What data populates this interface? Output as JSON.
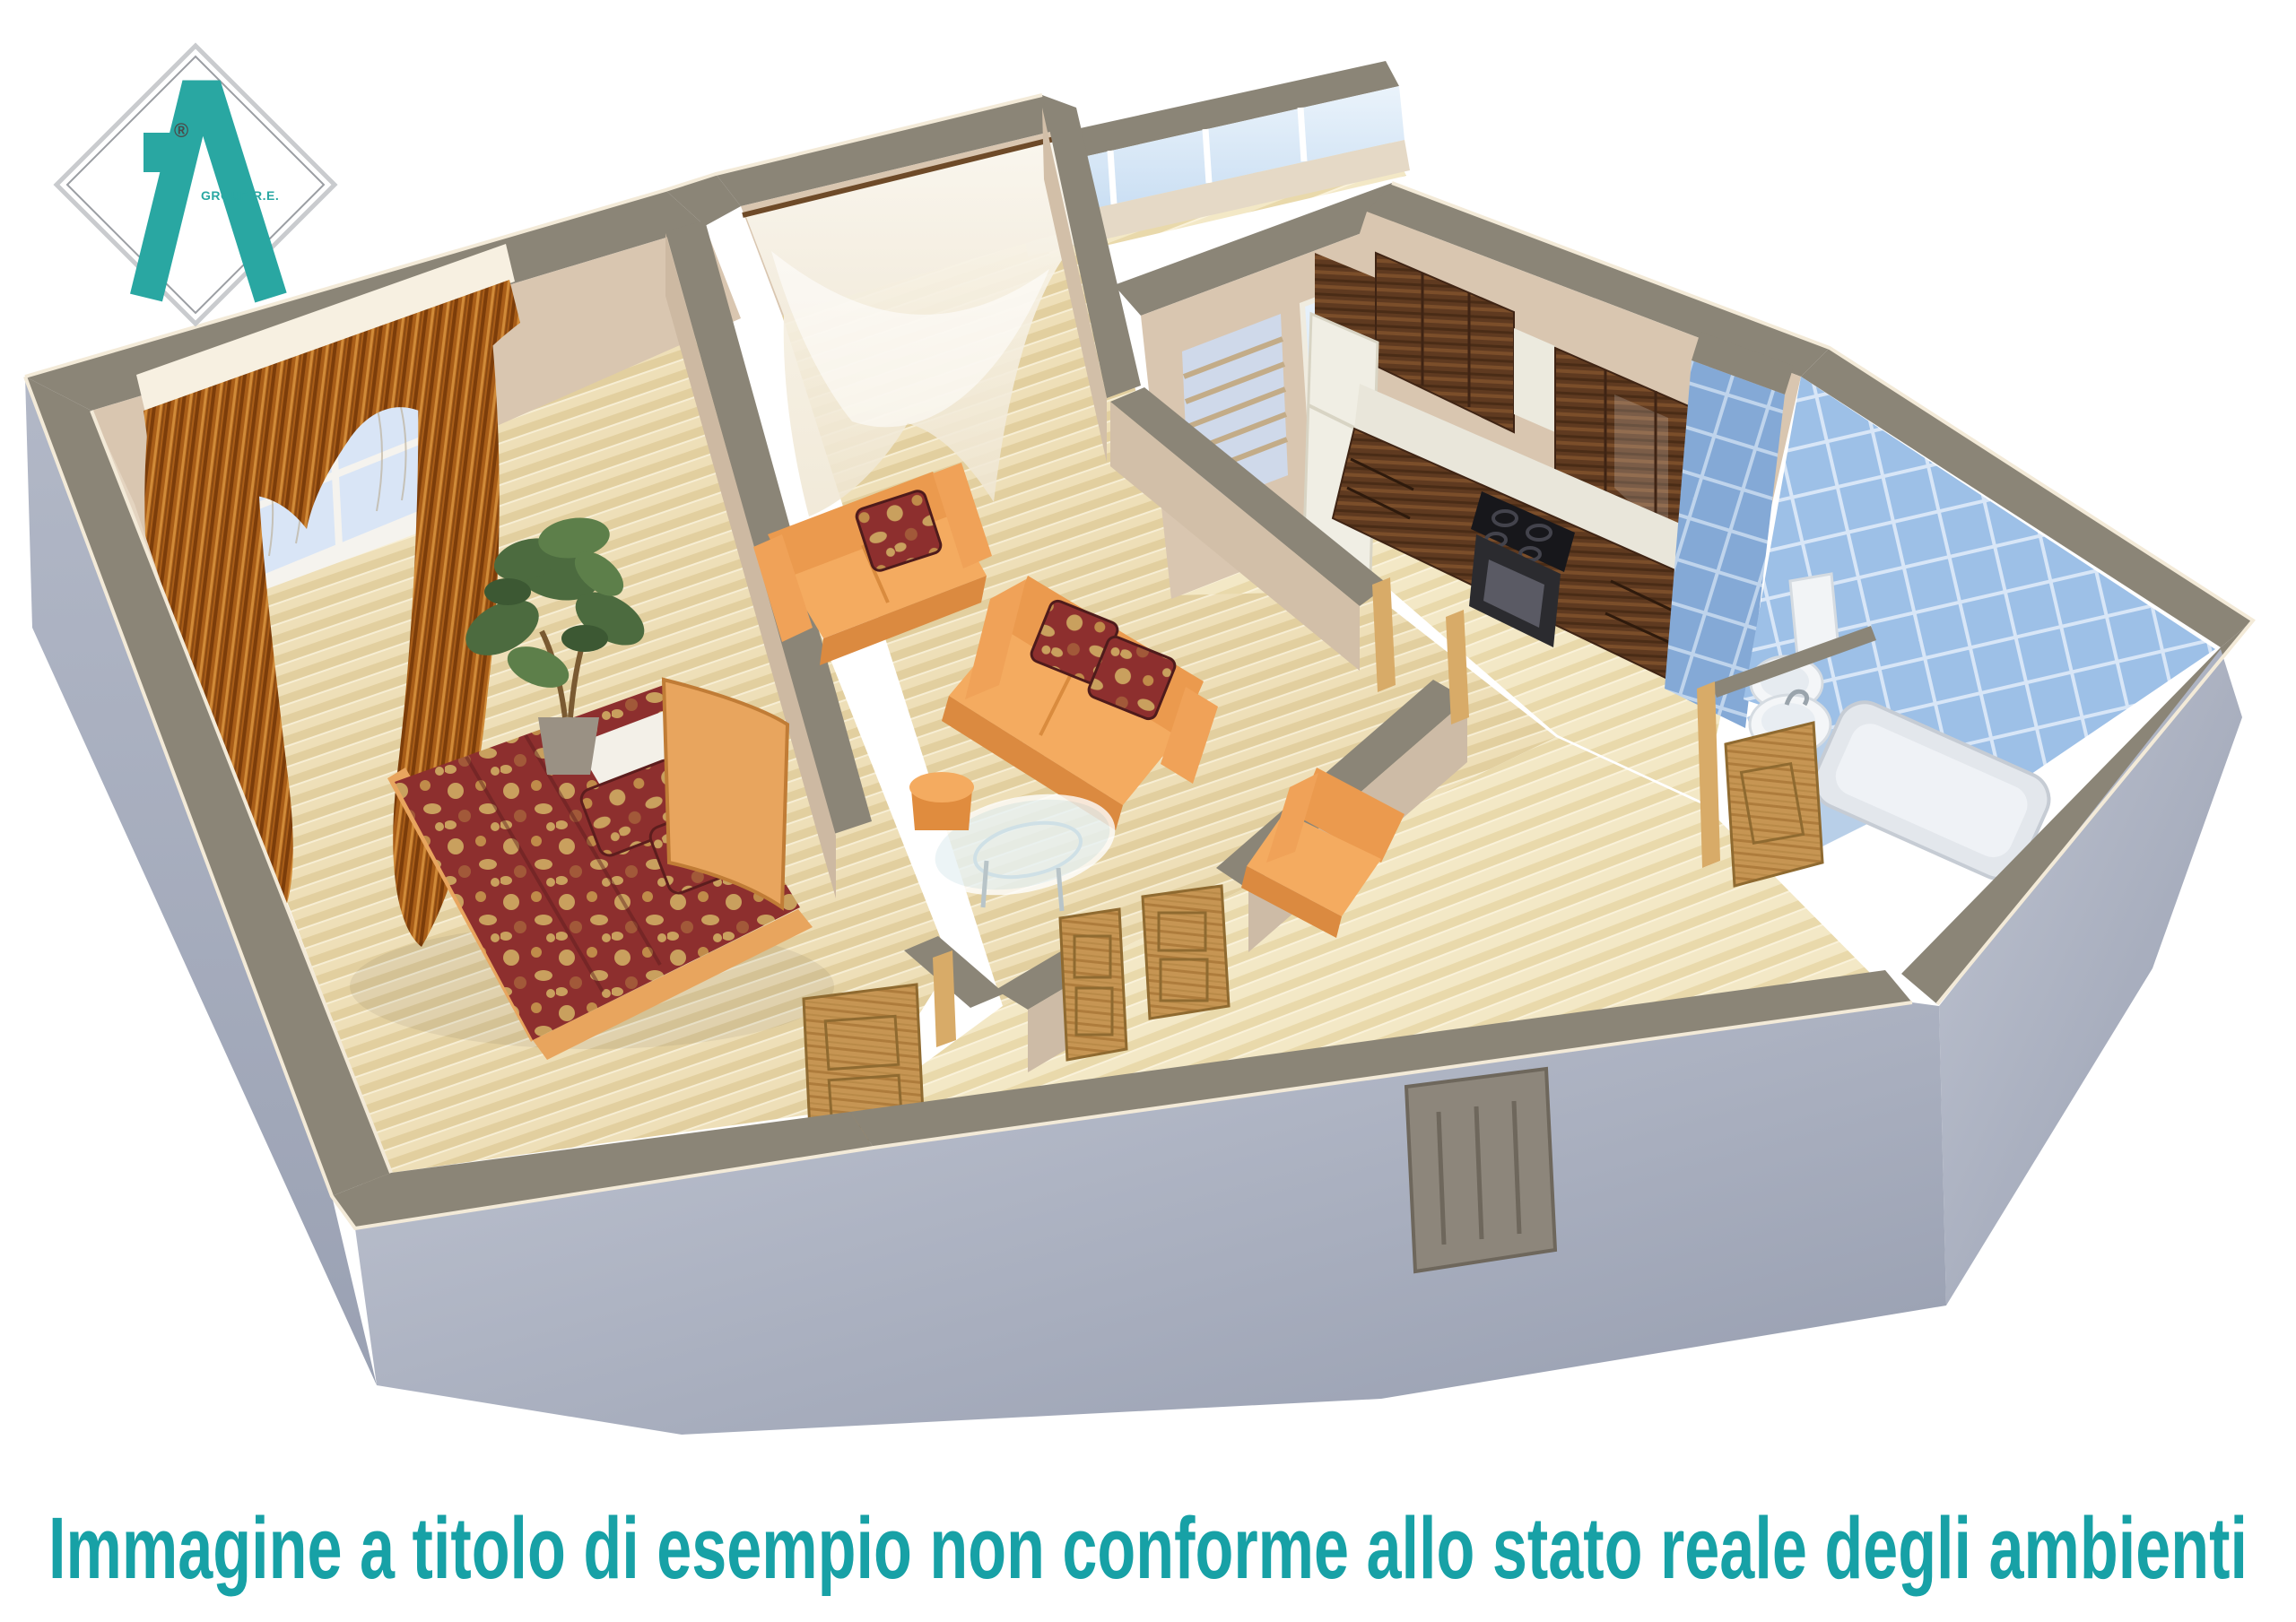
{
  "logo": {
    "brand_text": "GROUP R.E.",
    "registered": "®",
    "accent": "#29a7a2",
    "diamond_stroke": "#a7aaafff"
  },
  "caption": {
    "text": "Immagine a titolo di esempio non conforme allo stato reale degli ambienti",
    "color": "#17a1a6"
  },
  "palette": {
    "wall_top": "#8b8577",
    "wall_outer": "#a9aec0",
    "wall_inner": "#d9c6b0",
    "floor_wood": "#eedfb8",
    "floor_hall": "#f3e8c6",
    "bath_tile": "#9dc0e7",
    "sofa_orange": "#f4ab60",
    "bed_red": "#8d2f2e",
    "door_oak": "#c69553",
    "curtain_brown": "#a85d18"
  }
}
